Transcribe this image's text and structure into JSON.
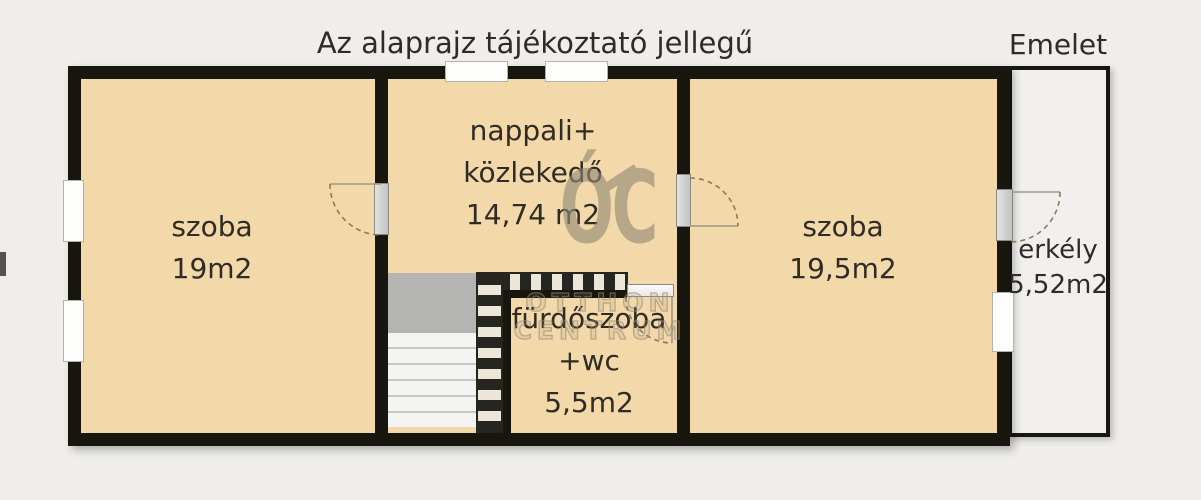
{
  "title": "Az alaprajz tájékoztató jellegű",
  "floor_label": "Emelet",
  "watermark": {
    "logo_text": "ÓC",
    "line1": "OTTHON",
    "line2": "CENTRUM"
  },
  "rooms": {
    "left_room": {
      "name": "szoba",
      "area": "19m2"
    },
    "living_room": {
      "name_line1": "nappali+",
      "name_line2": "közlekedő",
      "area": "14,74 m2"
    },
    "bathroom": {
      "name_line1": "fürdőszoba",
      "name_line2": "+wc",
      "area": "5,5m2"
    },
    "right_room": {
      "name": "szoba",
      "area": "19,5m2"
    },
    "balcony": {
      "name": "erkély",
      "area": "5,52m2"
    }
  },
  "colors": {
    "room_fill": "#f3d9a9",
    "wall": "#17160f",
    "watermark": "#948a77",
    "background": "#efeeeb",
    "stair_landing": "#b4b4b2"
  }
}
